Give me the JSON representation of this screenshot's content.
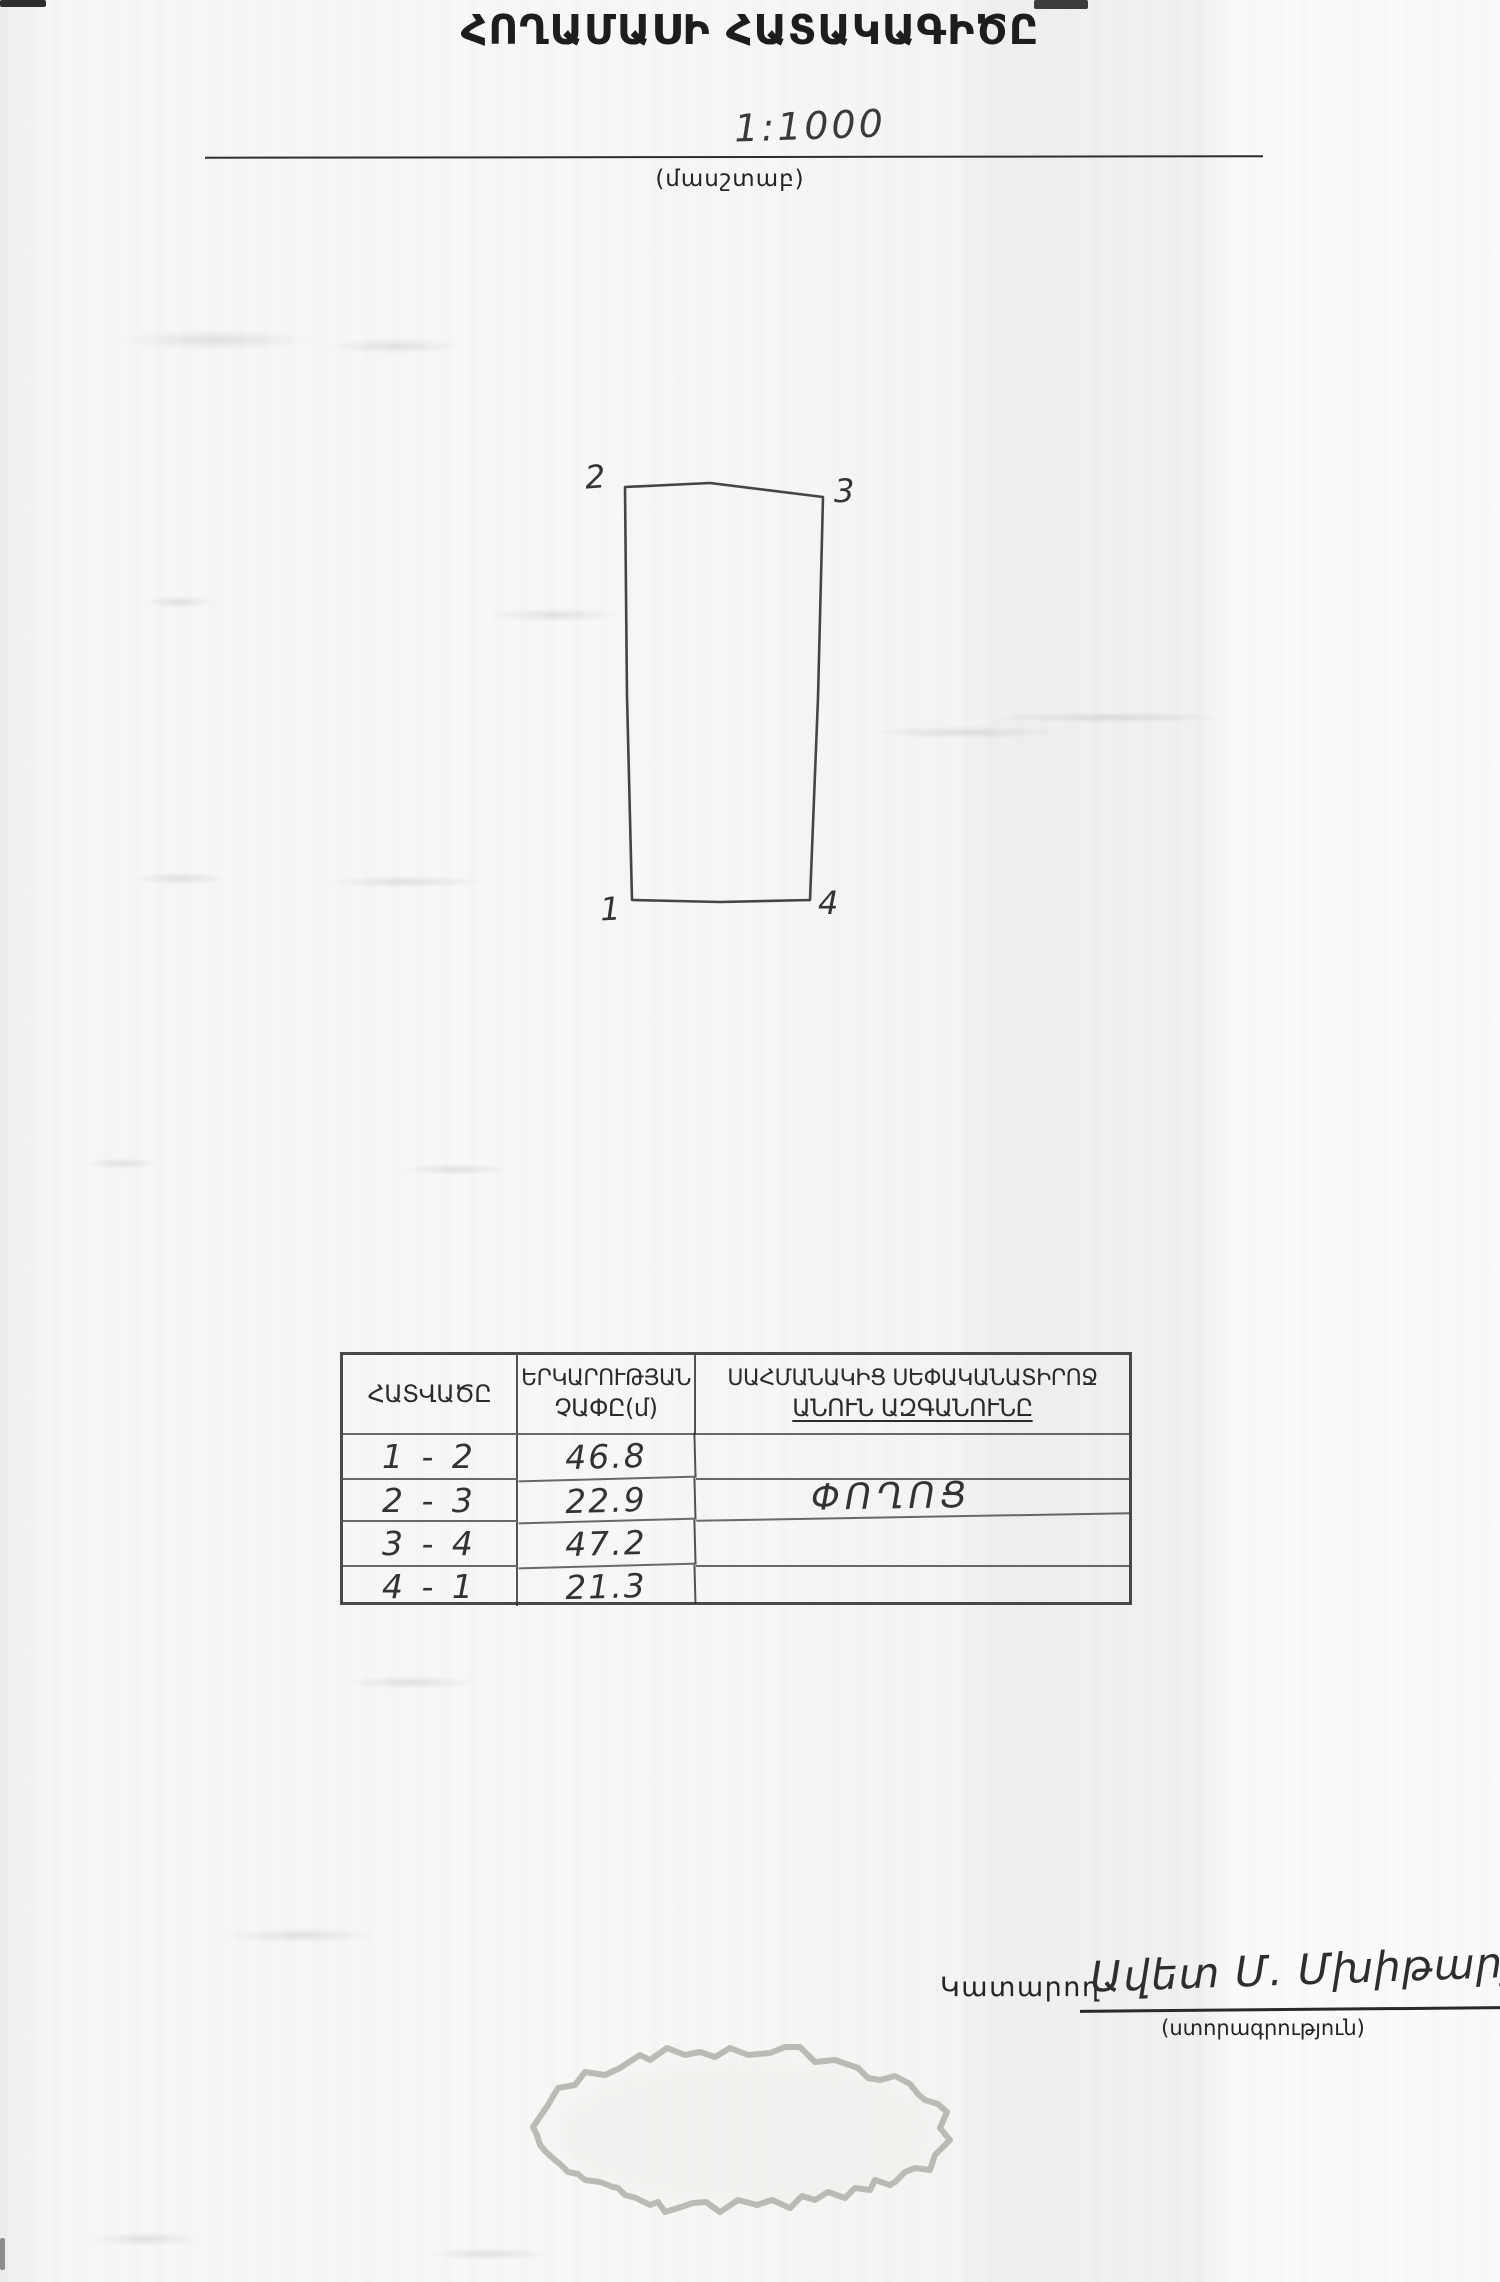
{
  "colors": {
    "paper": "#f6f6f4",
    "printed_ink": "#242424",
    "handwriting_ink": "#333333",
    "stamp_outline": "#b2b0ac"
  },
  "doc": {
    "title": "ՀՈՂԱՄԱՍԻ ՀԱՏԱԿԱԳԻԾԸ",
    "scale": {
      "value": "1:1000",
      "caption": "(մասշտաբ)"
    },
    "plot": {
      "corner_labels": [
        "1",
        "2",
        "3",
        "4"
      ]
    },
    "table": {
      "col1_header": "ՀԱՏՎԱԾԸ",
      "col2_header_line1": "ԵՐԿԱՐՈՒԹՅԱՆ",
      "col2_header_line2": "ՉԱՓԸ(մ)",
      "col3_header_line1": "ՍԱՀՄԱՆԱԿԻՑ ՍԵՓԱԿԱՆԱՏԻՐՈՋ",
      "col3_header_line2": "ԱՆՈՒՆ ԱԶԳԱՆՈՒՆԸ",
      "rows": [
        {
          "segment": "1 - 2",
          "length": "46.8",
          "owner": ""
        },
        {
          "segment": "2 - 3",
          "length": "22.9",
          "owner": "ՓՈՂՈՑ"
        },
        {
          "segment": "3 - 4",
          "length": "47.2",
          "owner": ""
        },
        {
          "segment": "4 - 1",
          "length": "21.3",
          "owner": ""
        }
      ]
    },
    "signature": {
      "label": "Կատարող",
      "name_handwritten": "Ավետ Մ. Մխիթարյան",
      "caption": "(ստորագրություն)"
    }
  }
}
